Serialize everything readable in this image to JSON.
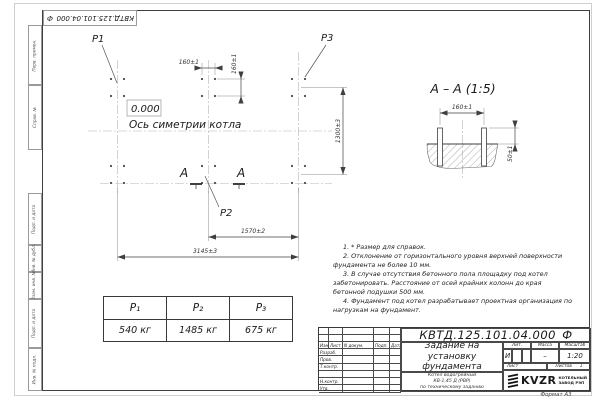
{
  "page": {
    "stamp_top": "КВТД.125.101.04.000 Ф",
    "format_label": "Формат А3"
  },
  "margin": {
    "labels": [
      "Перв. примен.",
      "Справ. №",
      "Подп. и дата",
      "Инв. № дубл.",
      "Взам. инв. №",
      "Подп. и дата",
      "Инв. № подл."
    ]
  },
  "plan": {
    "labels": {
      "p1": "P1",
      "p2": "P2",
      "p3": "P3",
      "elevation": "0.000",
      "axis": "Ось симетрии котла",
      "section_letter": "А"
    },
    "dims": {
      "bolt_h": "160±1",
      "bolt_v": "160±1",
      "width": "1300±3",
      "half_len": "1570±2",
      "total_len": "3145±3"
    }
  },
  "section_view": {
    "title": "А – А (1:5)",
    "dim_spacing": "160±1",
    "dim_height": "50±1"
  },
  "load_table": {
    "headers": [
      "P₁",
      "P₂",
      "P₃"
    ],
    "values": [
      "540 кг",
      "1485 кг",
      "675 кг"
    ]
  },
  "notes": [
    "1. * Размер для справок.",
    "2. Отклонение от горизонтального уровня верхней поверхности фундамента не более 10 мм.",
    "3. В случае отсутствия бетонного пола площадку под котел забетонировать. Расстояние от осей крайних колонн до края бетонной подушки 500 мм.",
    "4. Фундамент под котел разрабатывает проектная организация по нагрузкам на фундамент."
  ],
  "title_block": {
    "doc_number": "КВТД.125.101.04.000 Ф",
    "title_lines": [
      "Задание на",
      "установку",
      "фундамента"
    ],
    "product_lines": [
      "Котел водогрейный",
      "КВ-1,45 Д (РВР)",
      "по техническому заданию"
    ],
    "rev_headers": [
      "Изм.",
      "Лист",
      "N докум.",
      "Подп.",
      "Дата"
    ],
    "row_labels": [
      "Разраб.",
      "Пров.",
      "Т.контр.",
      "",
      "Н.контр.",
      "Утв."
    ],
    "lit_header": "Лит.",
    "mass_header": "Масса",
    "scale_header": "Масштаб",
    "lit_value": "И",
    "mass_value": "–",
    "scale_value": "1:20",
    "sheet_label": "Лист",
    "sheets_label": "Листов",
    "sheets_value": "1",
    "company": "KVZR",
    "company_sub": [
      "КОТЕЛЬНЫЙ",
      "ЗАВОД РЭП"
    ]
  },
  "colors": {
    "ink": "#3f3f3f",
    "paper": "#ffffff"
  }
}
